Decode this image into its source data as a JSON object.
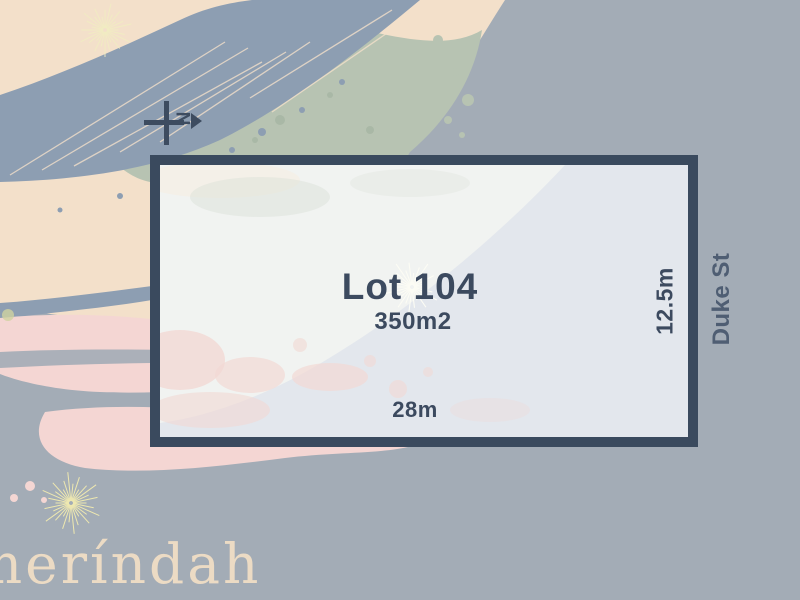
{
  "plan": {
    "lot_label": "Lot 104",
    "area_label": "350m2",
    "frontage_label": "28m",
    "side_label": "12.5m",
    "street_label": "Duke St",
    "north_letter": "N"
  },
  "watermark": {
    "brand_text": "meríndah"
  },
  "icons": {
    "north_arrow": "north-arrow-icon",
    "starburst": "starburst-icon"
  },
  "palette": {
    "background_gray": "#a3acb6",
    "lot_border_navy": "#3a4a5e",
    "lot_fill": "#e3e7ed",
    "text_navy": "#3c4a5f",
    "street_text": "#4f5e73",
    "art_peach": "#f3e0ca",
    "art_sage_green": "#b7c3b2",
    "art_pink": "#f4d6d3",
    "art_blue_gray": "#8d9eb2",
    "watermark_cream": "#ecdbc4",
    "starburst_pale_yellow": "#f1ecc2",
    "starburst_white": "#fcfcf4"
  }
}
